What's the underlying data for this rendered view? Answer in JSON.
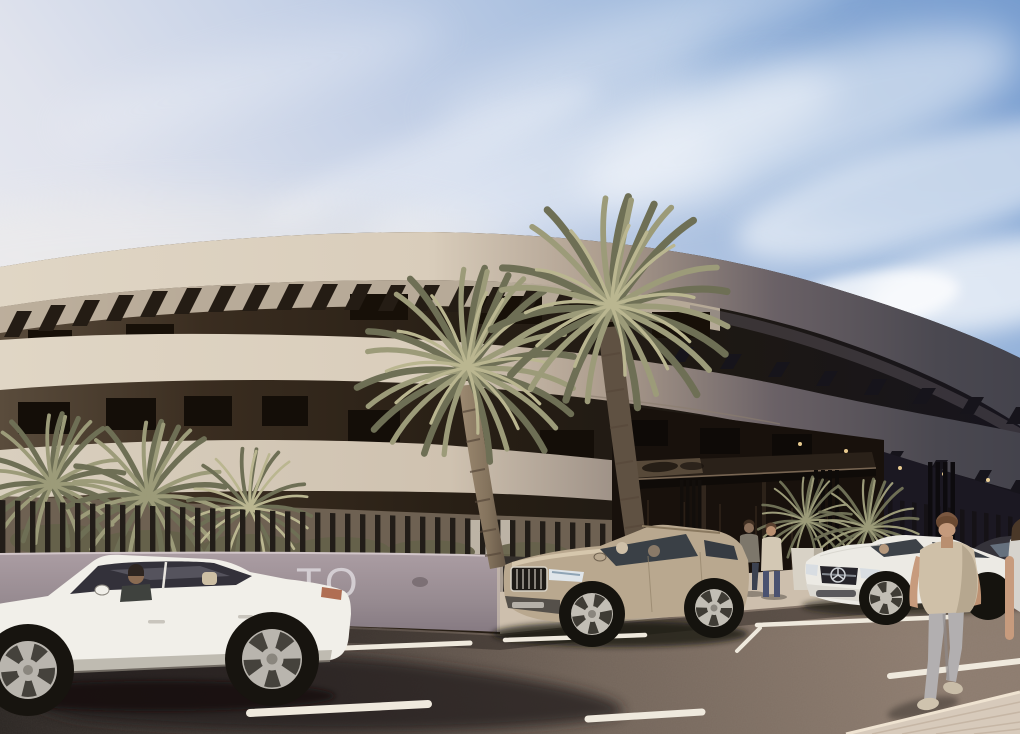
{
  "meta": {
    "title": "Architectural render — curved apartment building with palms, parked cars and pedestrians"
  },
  "scene": {
    "description": "Sunny exterior rendering of a modern curved three-storey residential building with rooftop pergola slats, dark recessed balconies, an entrance canopy, palm trees, a slatted fence over a mauve wall, parked cars on the street and people walking",
    "sign": {
      "text": "TO"
    },
    "objects": {
      "building": "curved cream apartment block, shadowed right wing",
      "vehicles": [
        "white sedan",
        "champagne SUV",
        "white Mercedes sedan",
        "dark grey car"
      ],
      "people": [
        "driver in sedan",
        "two SUV occupants",
        "two people at entrance",
        "man walking in foreground",
        "partial pedestrian at right edge"
      ],
      "vegetation": [
        "two tall center palms",
        "left palm cluster",
        "entrance palm bushes"
      ]
    },
    "colors": {
      "sky_blue": "#7fa3d4",
      "sky_pale": "#f2f1f2",
      "cloud": "#ffffff",
      "facade_cream": "#ddd3c2",
      "facade_shadow": "#46444e",
      "recess": "#2c2218",
      "pergola": "#241c14",
      "teeth": "#16141b",
      "wall": "#9b8e94",
      "sign": "#d9d4d8",
      "fence": "#221d18",
      "ground": "#7a6a56",
      "walkway": "#cdbfad",
      "road": "#7d6f64",
      "road_shadow": "#241f1c",
      "marking": "#efe9dd",
      "sidewalk": "#d7cabb",
      "palm_light": "#9c9b79",
      "palm_dark": "#6e6f55",
      "palm_highlight": "#bab690",
      "trunk": "#8d7c64",
      "sedan": "#f1efe9",
      "suv": "#b9a88f",
      "mercedes": "#eceae4",
      "dark_car": "#35333a",
      "glass": "#3a4046",
      "skin": "#c79b7d",
      "shirt": "#cfc0a8",
      "jeans": "#b2afb0",
      "hair": "#6b4a33",
      "canopy": "#2a2119",
      "planter": "#d8d2c6",
      "downlight": "#ffdf9e"
    }
  }
}
